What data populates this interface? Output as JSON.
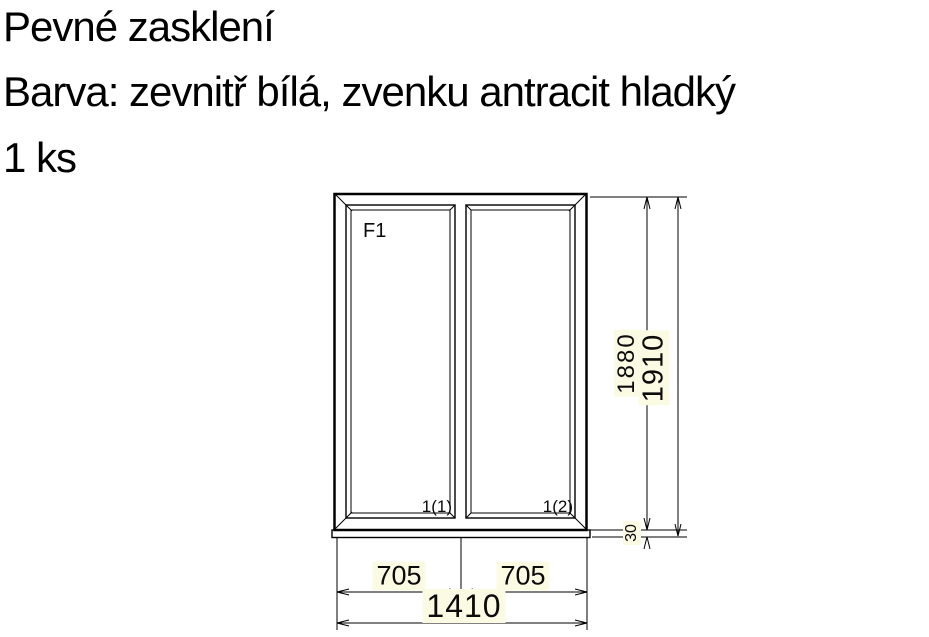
{
  "header": {
    "title": "Pevné zasklení",
    "color_spec": "Barva: zevnitř bílá, zvenku antracit hladký",
    "quantity": "1 ks"
  },
  "drawing": {
    "frame_label": "F1",
    "pane_labels": [
      "1(1)",
      "1(2)"
    ],
    "dimensions": {
      "pane_width_left": "705",
      "pane_width_right": "705",
      "total_width": "1410",
      "frame_height": "1880",
      "total_height": "1910",
      "sill_extension": "30"
    },
    "colors": {
      "glass": "#eef5f9",
      "frame_fill": "#ffffff",
      "line": "#000000",
      "dim_label_bg": "#fbfbe4"
    }
  }
}
